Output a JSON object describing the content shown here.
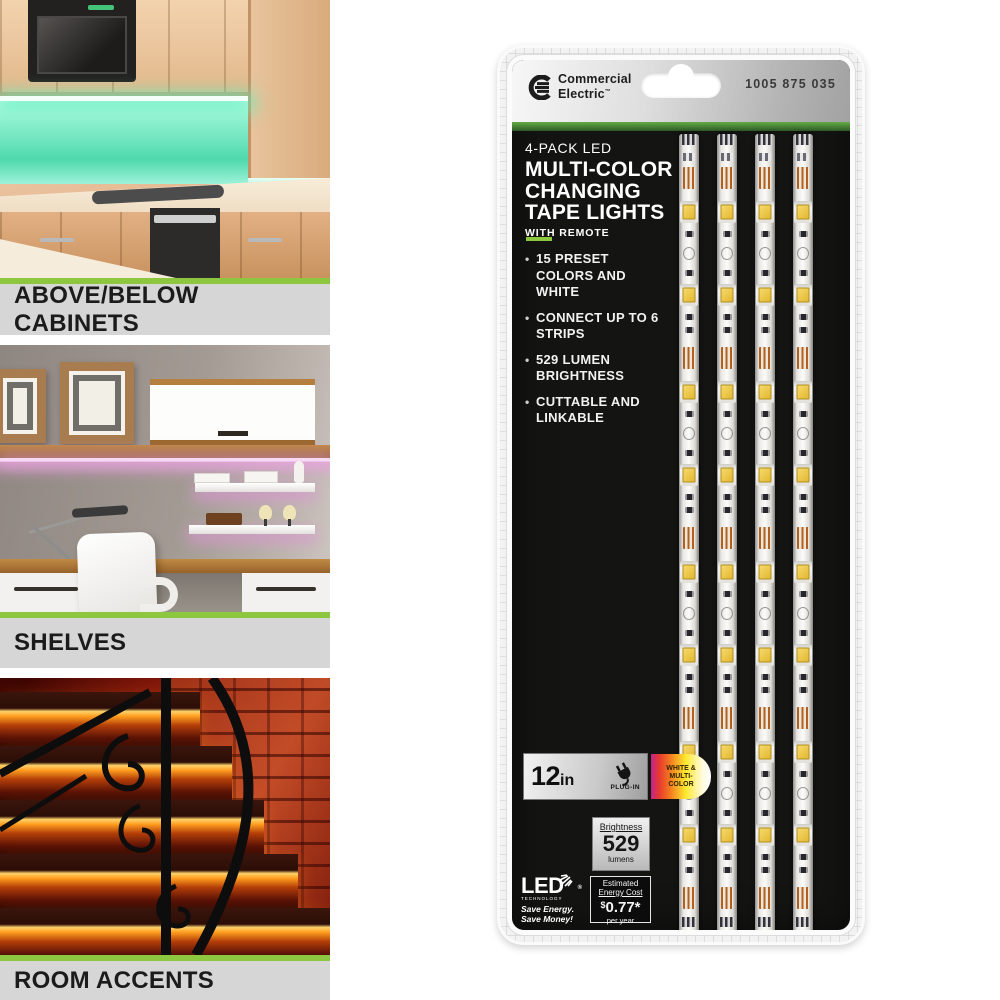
{
  "colors": {
    "accent_green": "#8dc63f"
  },
  "left_column": {
    "sections": [
      {
        "label": "ABOVE/BELOW CABINETS",
        "scene": "kitchen-green-under-cabinet-lighting"
      },
      {
        "label": "SHELVES",
        "scene": "home-office-shelves-purple-lighting"
      },
      {
        "label": "ROOM ACCENTS",
        "scene": "staircase-red-accent-lighting"
      }
    ]
  },
  "package": {
    "brand": {
      "line1": "Commercial",
      "line2": "Electric",
      "tm": "™"
    },
    "sku": "1005 875 035",
    "title": {
      "line1": "4-PACK LED",
      "line2": "MULTI-COLOR",
      "line3": "CHANGING",
      "line4": "TAPE LIGHTS",
      "line5": "WITH REMOTE"
    },
    "features": [
      "15 PRESET COLORS AND WHITE",
      "CONNECT UP TO 6 STRIPS",
      "529 LUMEN BRIGHTNESS",
      "CUTTABLE AND LINKABLE"
    ],
    "spec_bar": {
      "length_value": "12",
      "length_unit": "in",
      "power_label": "PLUG-IN",
      "color_badge": "WHITE & MULTI-COLOR"
    },
    "brightness_box": {
      "heading": "Brightness",
      "value": "529",
      "unit": "lumens"
    },
    "energy_box": {
      "heading_line1": "Estimated",
      "heading_line2": "Energy Cost",
      "currency": "$",
      "amount": "0.77*",
      "unit": "per year"
    },
    "led_logo": {
      "word": "LED",
      "sub": "TECHNOLOGY",
      "reg": "®",
      "tagline1": "Save Energy.",
      "tagline2": "Save Money!"
    },
    "strip_count": 4
  }
}
